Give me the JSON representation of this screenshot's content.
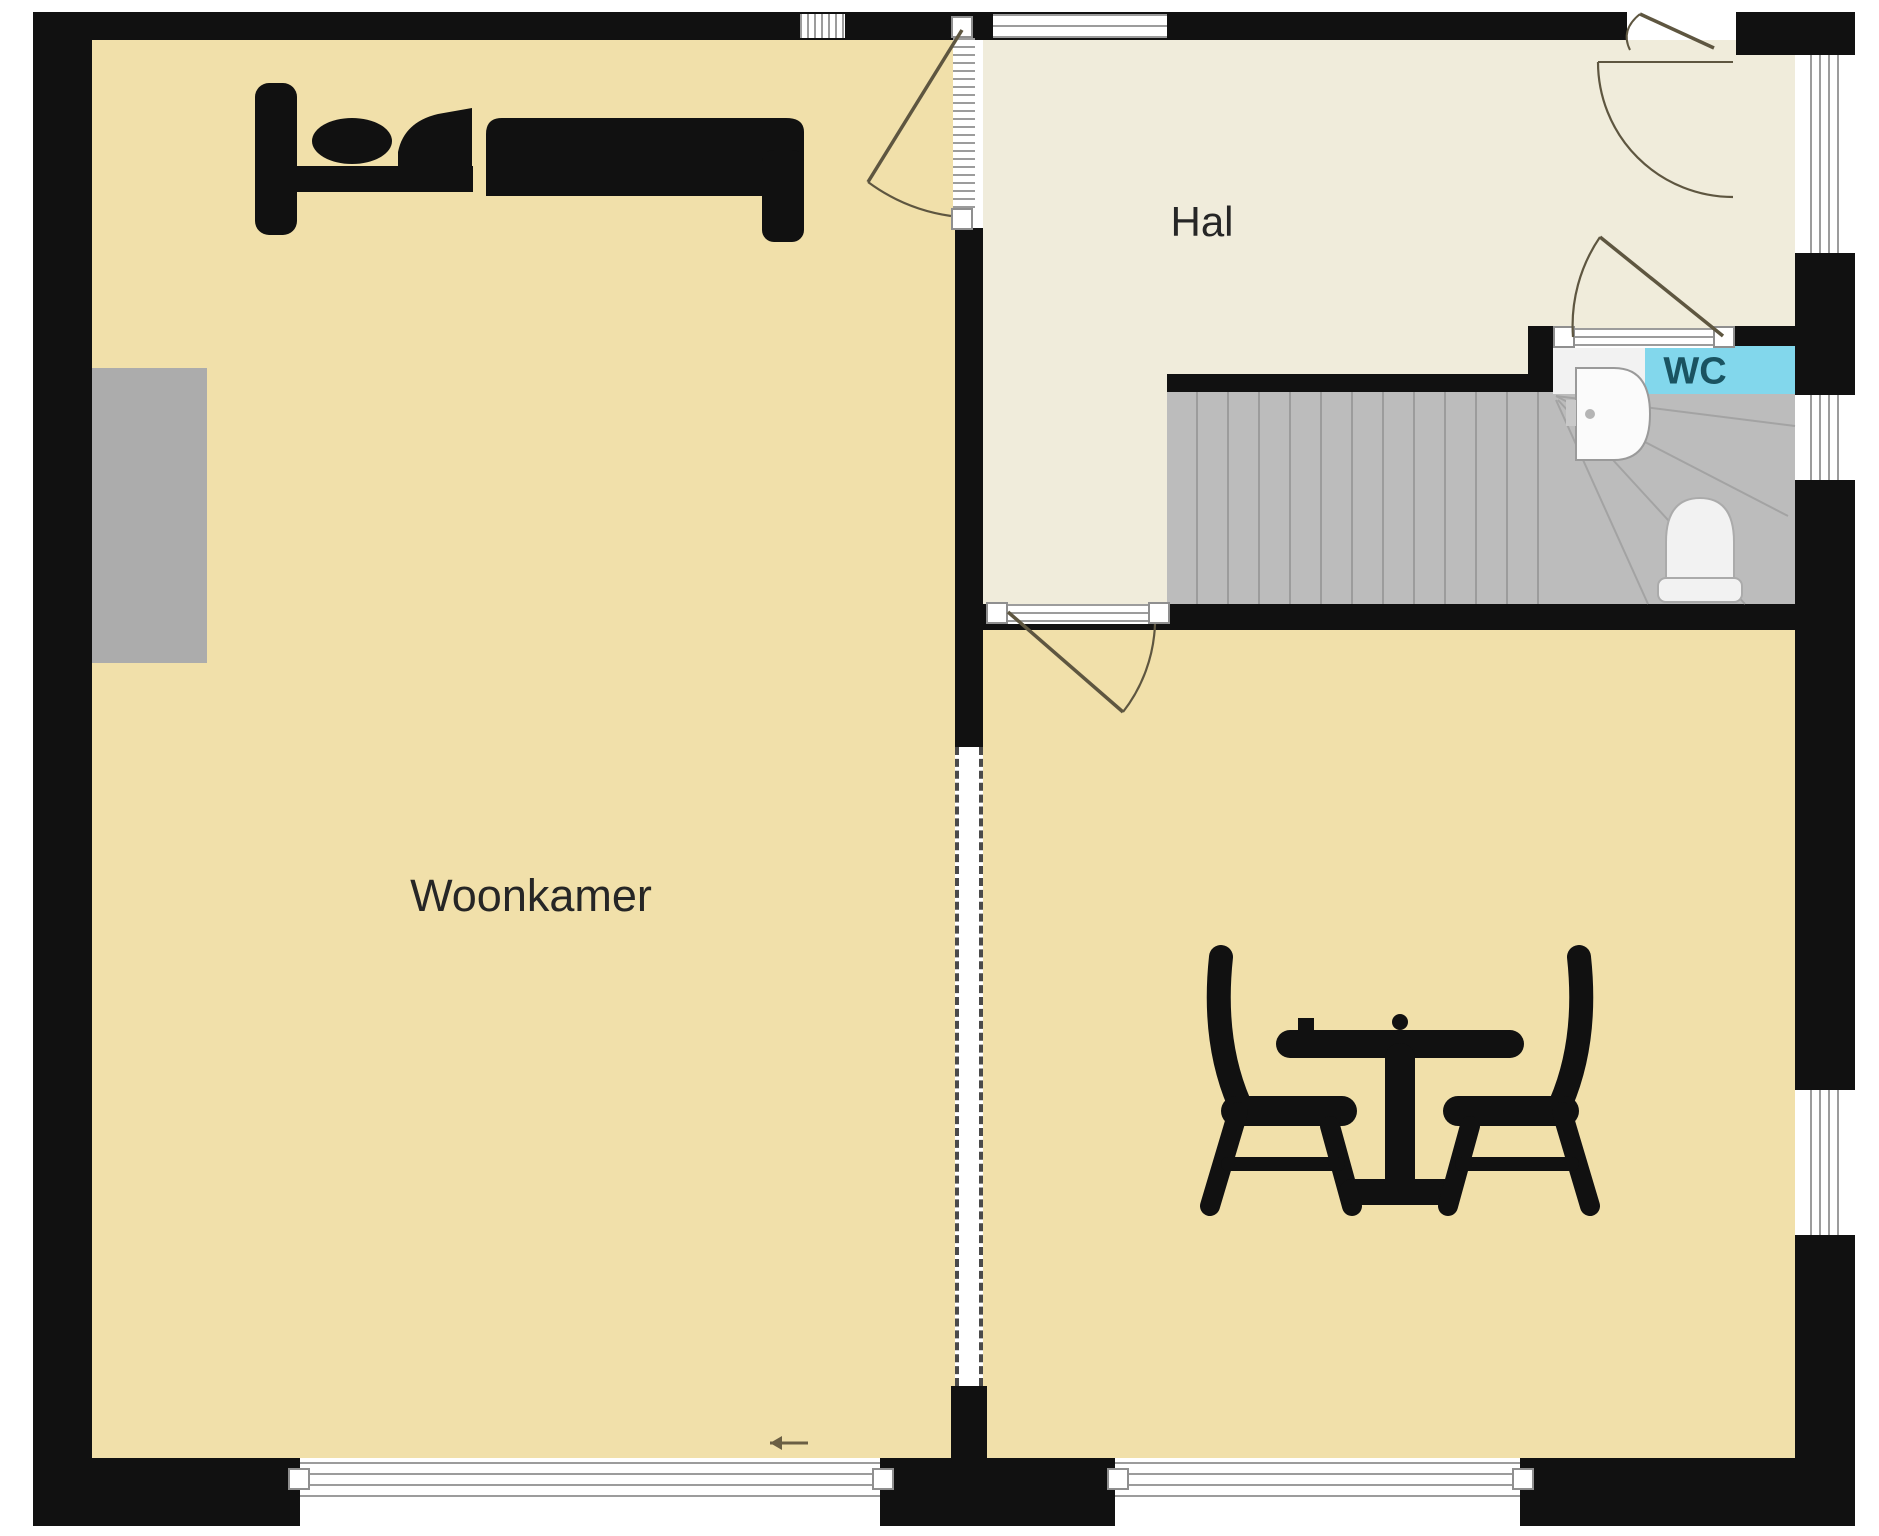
{
  "plan": {
    "labels": {
      "living_room": "Woonkamer",
      "hall": "Hal",
      "toilet": "WC"
    },
    "colors": {
      "wall": "#111111",
      "floor_living": "#F1E0AA",
      "floor_hall": "#F0ECDB",
      "wc_band": "#82D7EC",
      "stairs": "#BCBCBC",
      "room_label": "#262626",
      "wc_label": "#1A5361",
      "door_swing": "#5E5640",
      "radiator": "#ACACAC"
    },
    "icons": {
      "bed": "bed-icon",
      "dining_set": "table-with-two-chairs-icon",
      "toilet": "toilet-icon",
      "sink": "sink-icon",
      "staircase": "staircase-treads",
      "entry_arrow": "left-arrow-icon"
    }
  }
}
